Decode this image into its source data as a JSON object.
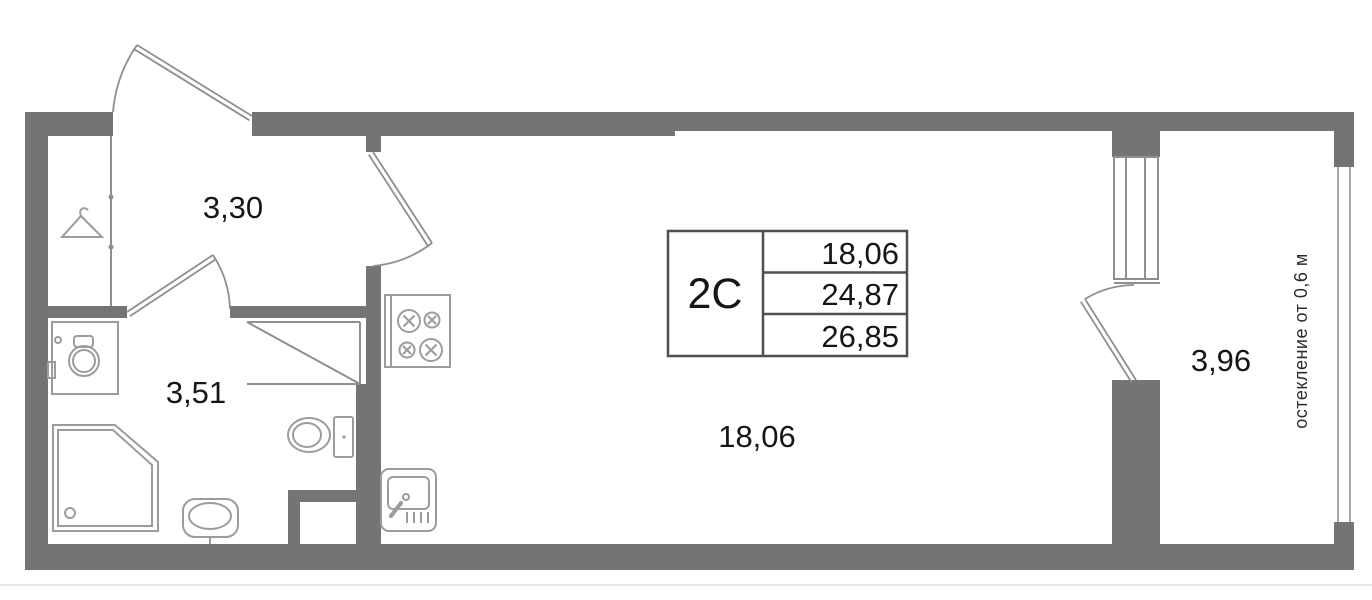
{
  "title": "apartment-floor-plan",
  "stamp": {
    "unit_type": "2С",
    "rows": [
      "18,06",
      "24,87",
      "26,85"
    ]
  },
  "rooms": {
    "hallway": {
      "area": "3,30"
    },
    "bathroom": {
      "area": "3,51"
    },
    "living": {
      "area": "18,06"
    },
    "balcony": {
      "area": "3,96"
    }
  },
  "notes": {
    "glazing": "остекление от 0,6 м"
  },
  "colors": {
    "wall": "#747474",
    "door_line": "#8f8f8f",
    "fixture_line": "#9c9c9c",
    "glazing_line": "#a8a8a8",
    "stamp_border": "#4f4f4f",
    "text": "#161616",
    "background": "#ffffff"
  },
  "fixtures": [
    "hanger-icon",
    "washing-machine-icon",
    "shower-cabin-icon",
    "toilet-icon",
    "washbasin-icon",
    "stove-icon",
    "kitchen-sink-icon"
  ]
}
